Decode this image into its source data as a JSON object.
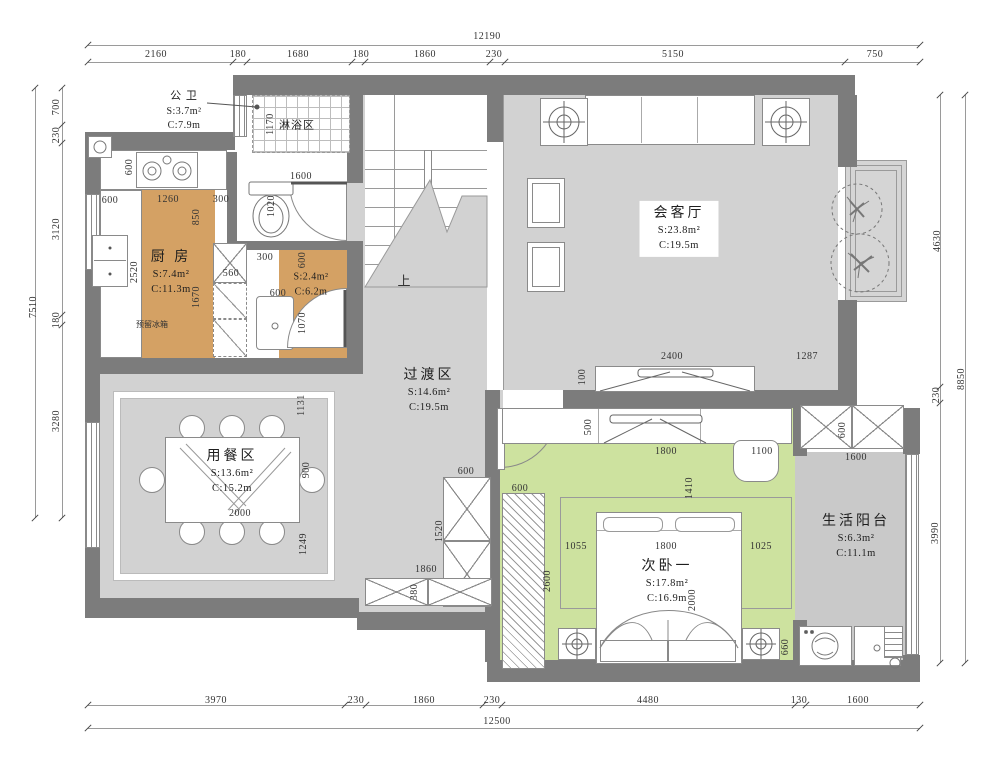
{
  "meta": {
    "type": "residential-floor-plan"
  },
  "colors": {
    "wall": "#7c7c7c",
    "floor": "#d2d2d2",
    "floor_dark": "#c9c9c9",
    "kitchen": "#d4a164",
    "bedroom": "#cde29f",
    "line": "#9a9a9a",
    "text": "#333333"
  },
  "rooms": [
    {
      "name": "公 卫",
      "s": "S:3.7m²",
      "c": "C:7.9m",
      "x": 184,
      "y": 111,
      "small": true,
      "boxed": false
    },
    {
      "name": "淋浴区",
      "s": "",
      "c": "",
      "x": 297,
      "y": 126,
      "small": true,
      "boxed": false
    },
    {
      "name": "厨 房",
      "s": "S:7.4m²",
      "c": "C:11.3m",
      "x": 171,
      "y": 273,
      "small": false,
      "boxed": false
    },
    {
      "name": "",
      "s": "S:2.4m²",
      "c": "C:6.2m",
      "x": 311,
      "y": 283,
      "small": true,
      "boxed": false
    },
    {
      "name": "会客厅",
      "s": "S:23.8m²",
      "c": "C:19.5m",
      "x": 679,
      "y": 229,
      "small": false,
      "boxed": true
    },
    {
      "name": "过渡区",
      "s": "S:14.6m²",
      "c": "C:19.5m",
      "x": 429,
      "y": 391,
      "small": false,
      "boxed": false
    },
    {
      "name": "用餐区",
      "s": "S:13.6m²",
      "c": "C:15.2m",
      "x": 232,
      "y": 472,
      "small": false,
      "boxed": false
    },
    {
      "name": "次卧一",
      "s": "S:17.8m²",
      "c": "C:16.9m",
      "x": 667,
      "y": 582,
      "small": false,
      "boxed": false
    },
    {
      "name": "生活阳台",
      "s": "S:6.3m²",
      "c": "C:11.1m",
      "x": 856,
      "y": 537,
      "small": false,
      "boxed": false
    }
  ],
  "dims": [
    {
      "t": "12190",
      "x": 487,
      "y": 37,
      "v": false
    },
    {
      "t": "2160",
      "x": 156,
      "y": 55,
      "v": false
    },
    {
      "t": "180",
      "x": 238,
      "y": 55,
      "v": false
    },
    {
      "t": "1680",
      "x": 298,
      "y": 55,
      "v": false
    },
    {
      "t": "180",
      "x": 361,
      "y": 55,
      "v": false
    },
    {
      "t": "1860",
      "x": 425,
      "y": 55,
      "v": false
    },
    {
      "t": "230",
      "x": 494,
      "y": 55,
      "v": false
    },
    {
      "t": "5150",
      "x": 673,
      "y": 55,
      "v": false
    },
    {
      "t": "750",
      "x": 875,
      "y": 55,
      "v": false
    },
    {
      "t": "7510",
      "x": 34,
      "y": 307,
      "v": true
    },
    {
      "t": "700",
      "x": 57,
      "y": 107,
      "v": true
    },
    {
      "t": "230",
      "x": 57,
      "y": 135,
      "v": true
    },
    {
      "t": "3120",
      "x": 57,
      "y": 229,
      "v": true
    },
    {
      "t": "180",
      "x": 57,
      "y": 320,
      "v": true
    },
    {
      "t": "3280",
      "x": 57,
      "y": 421,
      "v": true
    },
    {
      "t": "4630",
      "x": 938,
      "y": 241,
      "v": true
    },
    {
      "t": "8850",
      "x": 962,
      "y": 379,
      "v": true
    },
    {
      "t": "230",
      "x": 937,
      "y": 395,
      "v": true
    },
    {
      "t": "3990",
      "x": 936,
      "y": 533,
      "v": true
    },
    {
      "t": "3970",
      "x": 216,
      "y": 701,
      "v": false
    },
    {
      "t": "230",
      "x": 356,
      "y": 701,
      "v": false
    },
    {
      "t": "1860",
      "x": 424,
      "y": 701,
      "v": false
    },
    {
      "t": "230",
      "x": 492,
      "y": 701,
      "v": false
    },
    {
      "t": "4480",
      "x": 648,
      "y": 701,
      "v": false
    },
    {
      "t": "130",
      "x": 799,
      "y": 701,
      "v": false
    },
    {
      "t": "1600",
      "x": 858,
      "y": 701,
      "v": false
    },
    {
      "t": "12500",
      "x": 497,
      "y": 722,
      "v": false
    },
    {
      "t": "1170",
      "x": 271,
      "y": 124,
      "v": true
    },
    {
      "t": "1600",
      "x": 301,
      "y": 177,
      "v": false
    },
    {
      "t": "1020",
      "x": 272,
      "y": 206,
      "v": true
    },
    {
      "t": "600",
      "x": 130,
      "y": 167,
      "v": true
    },
    {
      "t": "600",
      "x": 110,
      "y": 201,
      "v": false
    },
    {
      "t": "1260",
      "x": 168,
      "y": 200,
      "v": false
    },
    {
      "t": "300",
      "x": 221,
      "y": 200,
      "v": false
    },
    {
      "t": "850",
      "x": 197,
      "y": 217,
      "v": true
    },
    {
      "t": "2520",
      "x": 135,
      "y": 272,
      "v": true
    },
    {
      "t": "560",
      "x": 231,
      "y": 274,
      "v": false
    },
    {
      "t": "1670",
      "x": 197,
      "y": 297,
      "v": true
    },
    {
      "t": "300",
      "x": 265,
      "y": 258,
      "v": false
    },
    {
      "t": "600",
      "x": 278,
      "y": 294,
      "v": false
    },
    {
      "t": "1070",
      "x": 303,
      "y": 323,
      "v": true
    },
    {
      "t": "600",
      "x": 303,
      "y": 260,
      "v": true
    },
    {
      "t": "2400",
      "x": 672,
      "y": 357,
      "v": false
    },
    {
      "t": "1287",
      "x": 807,
      "y": 357,
      "v": false
    },
    {
      "t": "100",
      "x": 583,
      "y": 377,
      "v": true
    },
    {
      "t": "500",
      "x": 589,
      "y": 427,
      "v": true
    },
    {
      "t": "1800",
      "x": 666,
      "y": 452,
      "v": false
    },
    {
      "t": "1100",
      "x": 762,
      "y": 452,
      "v": false
    },
    {
      "t": "1410",
      "x": 690,
      "y": 488,
      "v": true
    },
    {
      "t": "1055",
      "x": 576,
      "y": 547,
      "v": false
    },
    {
      "t": "1800",
      "x": 666,
      "y": 547,
      "v": false
    },
    {
      "t": "1025",
      "x": 761,
      "y": 547,
      "v": false
    },
    {
      "t": "600",
      "x": 520,
      "y": 489,
      "v": false
    },
    {
      "t": "2600",
      "x": 548,
      "y": 581,
      "v": true
    },
    {
      "t": "2000",
      "x": 693,
      "y": 600,
      "v": true
    },
    {
      "t": "660",
      "x": 786,
      "y": 647,
      "v": true
    },
    {
      "t": "600",
      "x": 843,
      "y": 430,
      "v": true
    },
    {
      "t": "1600",
      "x": 856,
      "y": 458,
      "v": false
    },
    {
      "t": "600",
      "x": 466,
      "y": 472,
      "v": false
    },
    {
      "t": "1520",
      "x": 440,
      "y": 531,
      "v": true
    },
    {
      "t": "1860",
      "x": 426,
      "y": 570,
      "v": false
    },
    {
      "t": "380",
      "x": 415,
      "y": 592,
      "v": true
    },
    {
      "t": "1131",
      "x": 302,
      "y": 405,
      "v": true
    },
    {
      "t": "900",
      "x": 307,
      "y": 470,
      "v": true
    },
    {
      "t": "1249",
      "x": 304,
      "y": 544,
      "v": true
    },
    {
      "t": "2000",
      "x": 240,
      "y": 514,
      "v": false
    }
  ],
  "annotations": [
    {
      "t": "上",
      "x": 404,
      "y": 281,
      "size": 13
    },
    {
      "t": "预留冰箱",
      "x": 152,
      "y": 325,
      "size": 8
    }
  ]
}
